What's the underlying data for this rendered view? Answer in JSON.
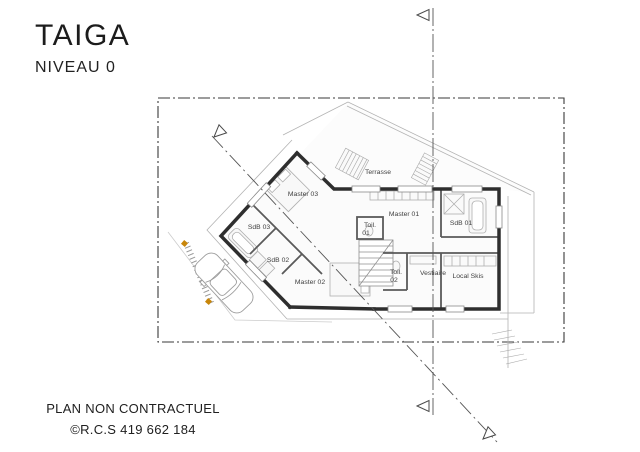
{
  "header": {
    "title": "TAIGA",
    "subtitle": "NIVEAU 0"
  },
  "footer": {
    "line1": "PLAN NON CONTRACTUEL",
    "line2": "©R.C.S 419 662 184"
  },
  "plan": {
    "rooms": [
      {
        "id": "terrasse",
        "label": "Terrasse"
      },
      {
        "id": "master-03",
        "label": "Master 03"
      },
      {
        "id": "master-01",
        "label": "Master 01"
      },
      {
        "id": "sdb-01",
        "label": "SdB 01"
      },
      {
        "id": "sdb-03",
        "label": "SdB 03"
      },
      {
        "id": "toil-01",
        "label": "Toil.",
        "label2": "01"
      },
      {
        "id": "sdb-02",
        "label": "SdB 02"
      },
      {
        "id": "toil-02",
        "label": "Toil.",
        "label2": "02"
      },
      {
        "id": "vestiaire",
        "label": "Vestiaire"
      },
      {
        "id": "local-skis",
        "label": "Local Skis"
      },
      {
        "id": "master-02",
        "label": "Master 02"
      }
    ],
    "colors": {
      "wall": "#2e2e2e",
      "interior_wall": "#5a5a5a",
      "light_line": "#c5c5c5",
      "medium_line": "#8a8a8a",
      "label_text": "#3f3f3f",
      "survey_marker": "#c8860a"
    }
  }
}
